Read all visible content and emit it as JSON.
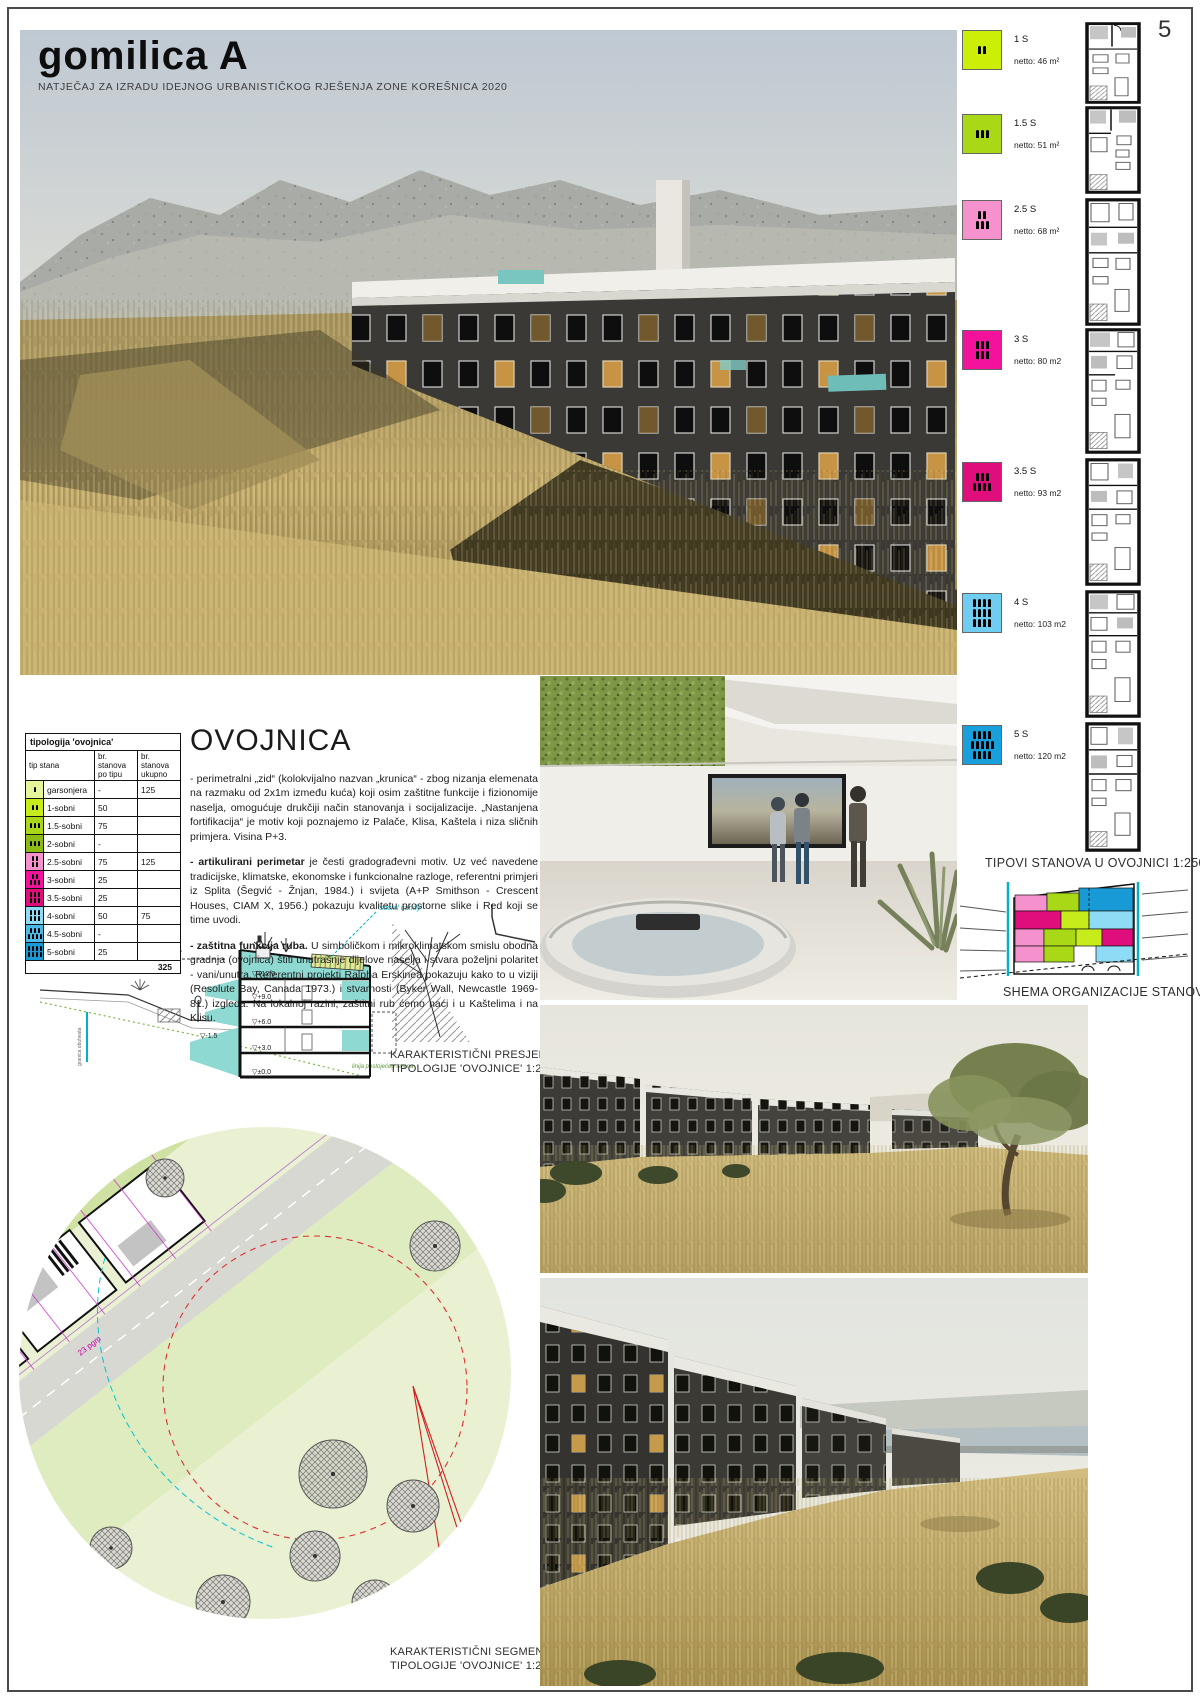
{
  "page": {
    "title": "gomilica A",
    "subtitle": "NATJEČAJ ZA IZRADU IDEJNOG URBANISTIČKOG RJEŠENJA ZONE KOREŠNICA 2020",
    "number": "5"
  },
  "legend": {
    "items": [
      {
        "label": "1 S",
        "netto": "netto: 46 m²",
        "color": "#cdee06"
      },
      {
        "label": "1.5 S",
        "netto": "netto: 51 m²",
        "color": "#a8d816"
      },
      {
        "label": "2.5 S",
        "netto": "netto: 68 m²",
        "color": "#f591cd"
      },
      {
        "label": "3 S",
        "netto": "netto: 80 m2",
        "color": "#f3129b"
      },
      {
        "label": "3.5 S",
        "netto": "netto: 93 m2",
        "color": "#e00d7d"
      },
      {
        "label": "4 S",
        "netto": "netto: 103 m2",
        "color": "#6fcdf1"
      },
      {
        "label": "5 S",
        "netto": "netto: 120 m2",
        "color": "#18a0dc"
      }
    ],
    "caption_tipovi": "TIPOVI STANOVA U OVOJNICI 1:250",
    "caption_shema": "SHEMA ORGANIZACIJE STANOVA"
  },
  "table": {
    "title": "tipologija 'ovojnica'",
    "headers": [
      "tip stana",
      "br. stanova po tipu",
      "br. stanova ukupno"
    ],
    "rows": [
      {
        "type": "garsonjera",
        "per_type": "-",
        "total": "125",
        "color": "#e6f599"
      },
      {
        "type": "1-sobni",
        "per_type": "50",
        "total": "",
        "color": "#c6ec1c"
      },
      {
        "type": "1.5-sobni",
        "per_type": "75",
        "total": "",
        "color": "#a8d816"
      },
      {
        "type": "2-sobni",
        "per_type": "-",
        "total": "",
        "color": "#8cbc14"
      },
      {
        "type": "2.5-sobni",
        "per_type": "75",
        "total": "125",
        "color": "#f591cd"
      },
      {
        "type": "3-sobni",
        "per_type": "25",
        "total": "",
        "color": "#f3129b"
      },
      {
        "type": "3.5-sobni",
        "per_type": "25",
        "total": "",
        "color": "#e00d7d"
      },
      {
        "type": "4-sobni",
        "per_type": "50",
        "total": "75",
        "color": "#8edbf5"
      },
      {
        "type": "4.5-sobni",
        "per_type": "-",
        "total": "",
        "color": "#4cb9e8"
      },
      {
        "type": "5-sobni",
        "per_type": "25",
        "total": "",
        "color": "#189ad6"
      }
    ],
    "total": "325"
  },
  "article": {
    "heading": "OVOJNICA",
    "p1": "- perimetralni „zid“ (kolokvijalno nazvan „krunica“ - zbog nizanja elemenata na razmaku od 2x1m između kuća) koji osim zaštitne funkcije i fizionomije naselja, omogućuje drukčiji način stanovanja i socijalizacije. „Nastanjena fortifikacija“ je motiv koji poznajemo iz Palače, Klisa, Kaštela i niza sličnih primjera. Visina P+3.",
    "p2_lead": "- artikulirani perimetar",
    "p2_rest": " je česti gradograđevni motiv. Uz već navedene tradicijske, klimatske, ekonomske i funkcionalne razloge, referentni primjeri iz Splita (Šegvić - Žnjan, 1984.) i svijeta (A+P Smithson - Crescent Houses, CIAM X, 1956.) pokazuju kvalitetu prostorne slike i Red koji se time uvodi.",
    "p3_lead": "- zaštitna funkcija ruba.",
    "p3_rest": " U simboličkom i mikroklimatskom smislu obodna gradnja (ovojnica) štiti unutrašnje dijelove naselja i stvara poželjni polaritet - vani/unutra. Referentni projekti Ralpha Erskinea pokazuju kako to u viziji (Resolute Bay, Canada 1973.) i stvarnosti (Byker Wall, Newcastle 1969-81.) izgleda. Na lokalnoj razini, zaštitni rub ćemo naći i u Kaštelima i na Klisu."
  },
  "section": {
    "view_label": "pogled na Split",
    "social_label": "'social candy'",
    "terrain_label": "linija postojećeg terena",
    "boundary_label": "granica obuhvata",
    "levels": [
      "▽+12.0",
      "▽+9.0",
      "▽+6.0",
      "▽+3.0",
      "▽±0.0",
      "▽-1.5"
    ],
    "caption1": "KARAKTERISTIČNI PRESJEK",
    "caption2": "TIPOLOGIJE 'OVOJNICE' 1:250"
  },
  "site": {
    "caption1": "KARAKTERISTIČNI SEGMENT",
    "caption2": "TIPOLOGIJE 'OVOJNICE' 1:250",
    "label_pgm_a": "23 pgm",
    "label_pgm_b": "23 pgm",
    "label_garage": "garaža"
  }
}
